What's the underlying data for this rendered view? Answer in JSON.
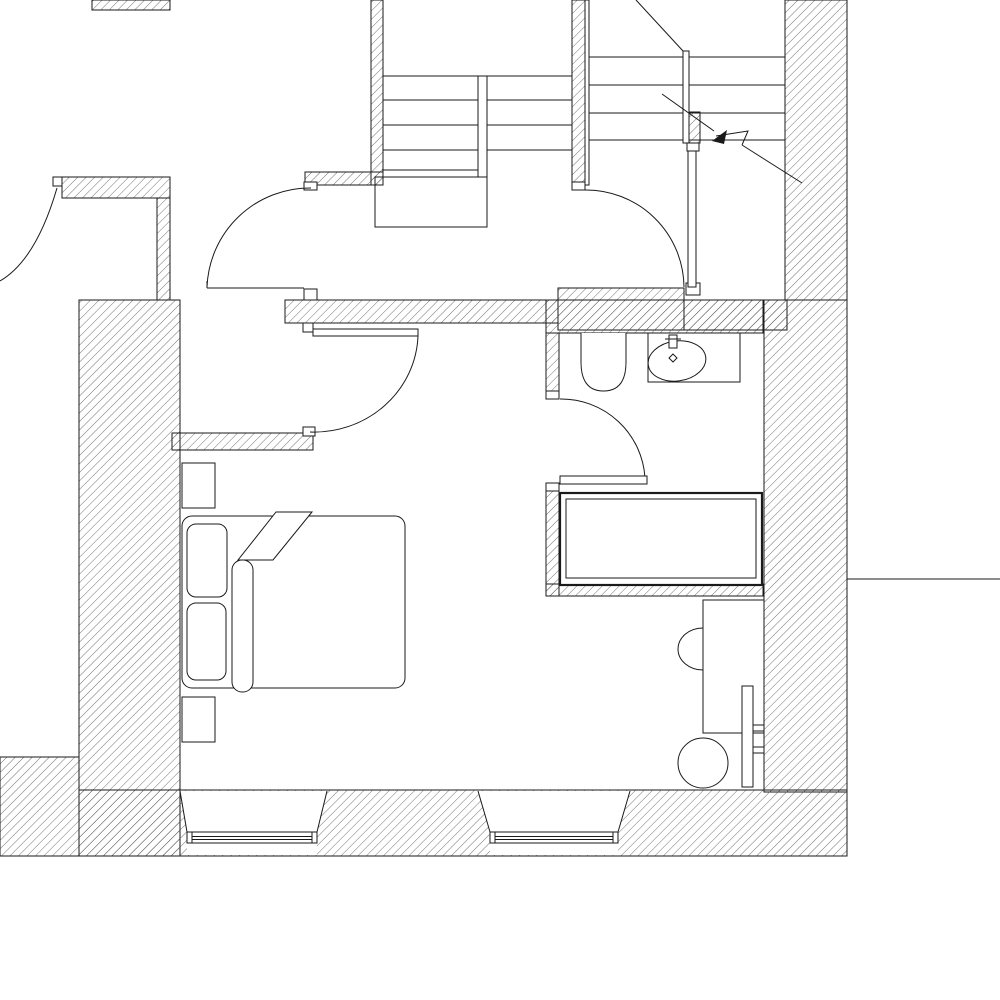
{
  "meta": {
    "type": "architectural floor plan",
    "description": "Monochrome CAD floor plan: stair hall with two stair flights and direction arrow, hallway with swing doors, bathroom with toilet, washbasin and bathtub, bedroom with double bed, nightstands, desk and chair, two splayed windows in the bottom exterior wall"
  },
  "palette": {
    "background": "#ffffff",
    "line_color": "#1a1a1a",
    "hatch_color": "#4f4f4f"
  },
  "plan": {
    "rooms": [
      {
        "name": "stair-hall"
      },
      {
        "name": "entrance-hall"
      },
      {
        "name": "bedroom"
      },
      {
        "name": "bathroom"
      }
    ],
    "fixtures": [
      "staircase-left-flight",
      "staircase-right-flight",
      "stair-direction-arrow",
      "swing-door-west",
      "swing-door-hall",
      "swing-door-stair-lobby",
      "swing-door-bedroom",
      "swing-door-bathroom",
      "toilet",
      "washbasin-counter",
      "faucet",
      "bathtub",
      "double-bed",
      "pillow",
      "pillow",
      "duvet-fold",
      "bed-runner",
      "nightstand",
      "nightstand",
      "desk",
      "desk-side-chair",
      "desk-chair",
      "radiator-strip",
      "window",
      "window"
    ]
  }
}
